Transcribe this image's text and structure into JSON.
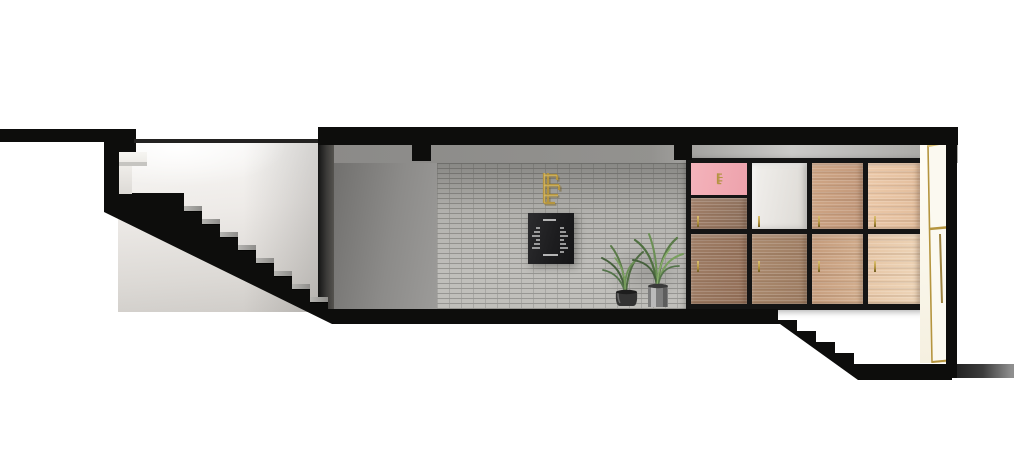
{
  "scene": {
    "kind": "architectural-section-render",
    "background": "#ffffff"
  },
  "palette": {
    "cut": "#0d0d0c",
    "ceiling_a": "#8b8a88",
    "ceiling_b": "#9a9995",
    "wall_gray_a": "#71706e",
    "wall_gray_b": "#9c9b99",
    "brick_base": "#bcbbb7",
    "brick_grout": "#8f8e8a",
    "tread_a": "#b6b5b2",
    "tread_b": "#8e8d8a",
    "board_a": "#2c2c2e",
    "board_b": "#151517",
    "board_text": "#cfcfcf",
    "brass": "#b5953f",
    "brass_light": "#dcc172",
    "brass_dark": "#6e5b22",
    "frame": "#141414",
    "door_fill": "#fbf9f0",
    "leaf_dark": "#46603c",
    "leaf_mid": "#5a7a48",
    "leaf_light": "#79a05e",
    "pot_dark": "#333333",
    "pot_metal": "#9b9b9b"
  },
  "structure": {
    "left_stairs": {
      "steps": 8,
      "start_x": 184,
      "start_y": 206,
      "run": 18,
      "rise": 13
    },
    "right_stairs": {
      "steps": 5
    },
    "beam_stubs": 2
  },
  "menu_board": {
    "legible": false,
    "has_title": true,
    "has_footer": true,
    "left_lines": 6,
    "right_lines": 7
  },
  "cabinet": {
    "columns": 4,
    "cells": [
      {
        "name": "pink-panel",
        "x": 5,
        "y": 5,
        "w": 56,
        "h": 32,
        "c1": "#f4b3bb",
        "c2": "#eda2ac",
        "emblem": true
      },
      {
        "name": "cabinet-door",
        "x": 5,
        "y": 40,
        "w": 56,
        "h": 31,
        "c1": "#a07e67",
        "c2": "#8d705c",
        "wood": true,
        "handle": [
          11,
          58
        ]
      },
      {
        "name": "cabinet-door",
        "x": 66,
        "y": 5,
        "w": 55,
        "h": 66,
        "c1": "#f2f0ed",
        "c2": "#dcd9d4",
        "plain": true,
        "handle": [
          72,
          58
        ]
      },
      {
        "name": "cabinet-door",
        "x": 126,
        "y": 5,
        "w": 51,
        "h": 66,
        "c1": "#cfa685",
        "c2": "#c1977a",
        "wood": true,
        "handle": [
          132,
          58
        ]
      },
      {
        "name": "cabinet-door",
        "x": 182,
        "y": 5,
        "w": 52,
        "h": 66,
        "c1": "#ecc9a9",
        "c2": "#e2bd9c",
        "wood": true,
        "handle": [
          188,
          58
        ]
      },
      {
        "name": "cabinet-door",
        "x": 5,
        "y": 76,
        "w": 56,
        "h": 70,
        "c1": "#9f7e66",
        "c2": "#936f58",
        "wood": true,
        "handle": [
          11,
          103
        ]
      },
      {
        "name": "cabinet-door",
        "x": 66,
        "y": 76,
        "w": 55,
        "h": 70,
        "c1": "#ab8a6e",
        "c2": "#9d7c62",
        "wood": true,
        "handle": [
          72,
          103
        ]
      },
      {
        "name": "cabinet-door",
        "x": 126,
        "y": 76,
        "w": 51,
        "h": 70,
        "c1": "#c49b7b",
        "c2": "#d4b090",
        "wood": true,
        "handle": [
          132,
          103
        ]
      },
      {
        "name": "cabinet-door",
        "x": 182,
        "y": 76,
        "w": 52,
        "h": 70,
        "c1": "#e6c6a6",
        "c2": "#eed5b8",
        "wood": true,
        "handle": [
          188,
          103
        ]
      }
    ]
  },
  "plants": {
    "count": 2,
    "pots": [
      "round-dark",
      "cylinder-metal"
    ]
  }
}
